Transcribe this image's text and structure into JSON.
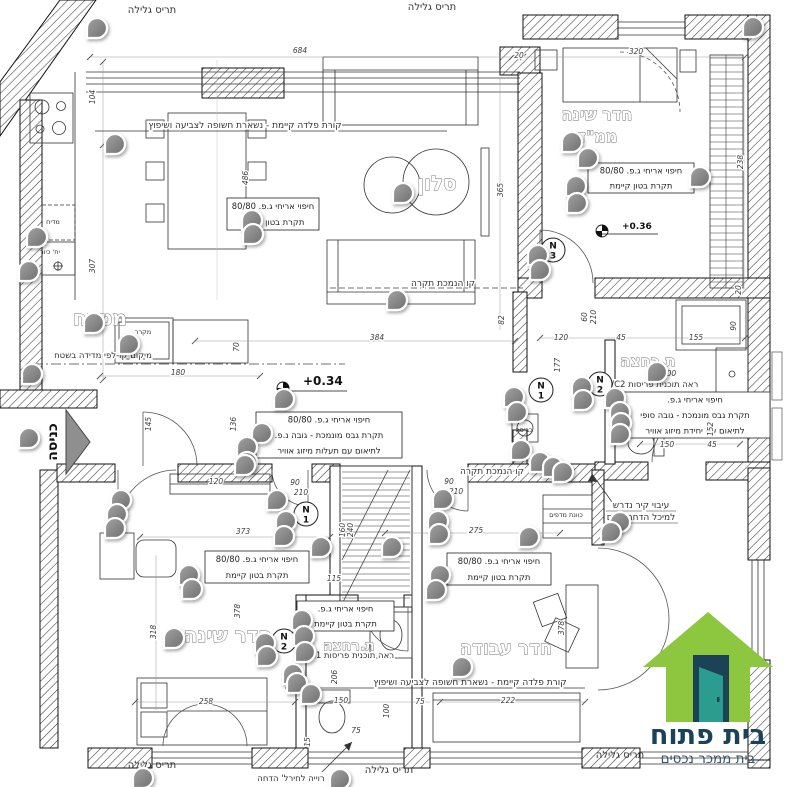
{
  "plan": {
    "entrance_label": "כניסה",
    "rooms": [
      {
        "t": "סלון",
        "x": 437,
        "y": 190,
        "s": 20
      },
      {
        "t": "מטבח",
        "x": 100,
        "y": 325,
        "s": 20
      },
      {
        "t": "חדר שינה",
        "x": 597,
        "y": 120,
        "s": 16
      },
      {
        "t": "ממ\"ד",
        "x": 597,
        "y": 142,
        "s": 16
      },
      {
        "t": "ת.רחצה",
        "x": 648,
        "y": 366,
        "s": 15
      },
      {
        "t": "חדר שינה",
        "x": 228,
        "y": 642,
        "s": 20
      },
      {
        "t": "ת.רחצה",
        "x": 349,
        "y": 650,
        "s": 14
      },
      {
        "t": "חדר עבודה",
        "x": 506,
        "y": 654,
        "s": 18
      }
    ],
    "annotations": [
      {
        "x": 227,
        "y": 198,
        "w": 92,
        "h": 32,
        "lines": [
          "חיפוי אריחי ג.פ. 80/80",
          "תקרת בטון קיימת"
        ]
      },
      {
        "x": 588,
        "y": 163,
        "w": 106,
        "h": 30,
        "lines": [
          "חיפוי אריחי ג.פ. 80/80",
          "תקרת בטון קיימת"
        ]
      },
      {
        "x": 256,
        "y": 412,
        "w": 146,
        "h": 46,
        "lines": [
          "חיפוי אריחי ג.פ. 80/80",
          "תקרת גבס מונמכת - גובה נ.פ.",
          "לתיאום עם תעלות מיזוג אוויר"
        ]
      },
      {
        "x": 620,
        "y": 392,
        "w": 150,
        "h": 46,
        "lines": [
          "חיפוי אריחי ג.פ.",
          "תקרת גבס מונמכת - גובה סופי",
          "לתיאום עם יחידת מיזוג אוויר"
        ]
      },
      {
        "x": 205,
        "y": 551,
        "w": 104,
        "h": 32,
        "lines": [
          "חיפוי אריחי ג.פ. 80/80",
          "תקרת בטון קיימת"
        ]
      },
      {
        "x": 447,
        "y": 553,
        "w": 104,
        "h": 32,
        "lines": [
          "חיפוי אריחי ג.פ. 80/80",
          "תקרת בטון קיימת"
        ]
      },
      {
        "x": 297,
        "y": 601,
        "w": 97,
        "h": 30,
        "lines": [
          "חיפוי אריחי ג.פ.",
          "תקרת בטון קיימת"
        ]
      }
    ],
    "notes": [
      {
        "t": "תריס גלילה",
        "x": 152,
        "y": 13,
        "s": 10
      },
      {
        "t": "תריס גלילה",
        "x": 432,
        "y": 10,
        "s": 10
      },
      {
        "t": "תריס גלילה",
        "x": 152,
        "y": 768,
        "s": 10
      },
      {
        "t": "תריס גלילה",
        "x": 389,
        "y": 773,
        "s": 10
      },
      {
        "t": "תריס גלילה",
        "x": 620,
        "y": 758,
        "s": 10
      },
      {
        "t": "קורת פלדה קיימת - נשארת חשופה לצביעה ושיפוץ",
        "x": 245,
        "y": 128,
        "s": 9,
        "halo": true
      },
      {
        "t": "קורת פלדה קיימת - נשארת חשופה לצביעה ושיפוץ",
        "x": 470,
        "y": 685,
        "s": 9,
        "halo": true
      },
      {
        "t": "קו הנמכת תקרה",
        "x": 443,
        "y": 286,
        "s": 9,
        "halo": true
      },
      {
        "t": "קו הנמכת תקרה",
        "x": 492,
        "y": 474,
        "s": 9,
        "halo": true
      },
      {
        "t": "מיקום קו-לפי מדידה בשטח",
        "x": 103,
        "y": 358,
        "s": 8.5,
        "halo": true
      },
      {
        "t": "ראה תוכנית פריסות WC2",
        "x": 652,
        "y": 387,
        "s": 8.5,
        "halo": true
      },
      {
        "t": "ראה תוכנית פריסות C1",
        "x": 352,
        "y": 658,
        "s": 8.5,
        "halo": true
      },
      {
        "t": "עיבוי קיר נדרש",
        "x": 641,
        "y": 508,
        "s": 9,
        "halo": true
      },
      {
        "t": "למיכל הדחה פנים",
        "x": 641,
        "y": 520,
        "s": 9,
        "halo": true
      },
      {
        "t": "רוייה לחירל' הדחה",
        "x": 291,
        "y": 781,
        "s": 8.5
      },
      {
        "t": "כוונת מדפים",
        "x": 566,
        "y": 517,
        "s": 6.5,
        "halo": true
      },
      {
        "t": "מדיח",
        "x": 53,
        "y": 224,
        "s": 6.5
      },
      {
        "t": "יח' כיור",
        "x": 50,
        "y": 254,
        "s": 6.5
      },
      {
        "t": "מקרר",
        "x": 143,
        "y": 334,
        "s": 6.5
      },
      {
        "t": "כביסה",
        "x": 524,
        "y": 432,
        "s": 6.5
      }
    ],
    "dims": [
      [
        "684",
        300,
        53
      ],
      [
        "320",
        636,
        54
      ],
      [
        "20",
        519,
        58
      ],
      [
        "104",
        95,
        97,
        -90
      ],
      [
        "307",
        95,
        266,
        -90
      ],
      [
        "70",
        239,
        347,
        -90
      ],
      [
        "486",
        248,
        178,
        -90
      ],
      [
        "365",
        503,
        190,
        -90
      ],
      [
        "384",
        377,
        340
      ],
      [
        "82",
        504,
        320,
        -90
      ],
      [
        "180",
        178,
        375
      ],
      [
        "145",
        151,
        424,
        -90
      ],
      [
        "136",
        236,
        424,
        -90
      ],
      [
        "238",
        743,
        162,
        -90
      ],
      [
        "90",
        736,
        326,
        -90
      ],
      [
        "20",
        741,
        290,
        -90
      ],
      [
        "120",
        561,
        340
      ],
      [
        "45",
        621,
        340
      ],
      [
        "155",
        696,
        340
      ],
      [
        "177",
        560,
        365,
        -90
      ],
      [
        "200",
        669,
        376
      ],
      [
        "60",
        587,
        317,
        -90
      ],
      [
        "210",
        596,
        317,
        -90
      ],
      [
        "150",
        667,
        447
      ],
      [
        "45",
        712,
        447
      ],
      [
        "152",
        713,
        429,
        -90
      ],
      [
        "90",
        295,
        485
      ],
      [
        "210",
        301,
        495
      ],
      [
        "90",
        449,
        484
      ],
      [
        "210",
        456,
        494
      ],
      [
        "120",
        216,
        484
      ],
      [
        "373",
        243,
        534
      ],
      [
        "275",
        476,
        533
      ],
      [
        "115",
        334,
        581
      ],
      [
        "318",
        156,
        632,
        -90
      ],
      [
        "378",
        240,
        611,
        -90
      ],
      [
        "378",
        564,
        628,
        -90
      ],
      [
        "160",
        345,
        530,
        -90
      ],
      [
        "240",
        353,
        530,
        -90
      ],
      [
        "258",
        206,
        704
      ],
      [
        "150",
        341,
        703
      ],
      [
        "100",
        389,
        711,
        -90
      ],
      [
        "75",
        420,
        704
      ],
      [
        "222",
        508,
        703
      ],
      [
        "75",
        356,
        733
      ],
      [
        "15",
        310,
        742,
        -90
      ],
      [
        "206",
        337,
        677,
        -90
      ]
    ],
    "levels": [
      {
        "t": "+0.34",
        "sx": 283,
        "sy": 388,
        "tx": 303,
        "ty": 385,
        "s": 12,
        "ux": 347
      },
      {
        "t": "+0.36",
        "sx": 602,
        "sy": 231,
        "tx": 622,
        "ty": 229,
        "s": 9,
        "ux": 658
      }
    ],
    "n_markers": [
      {
        "x": 541,
        "y": 390,
        "n": "1"
      },
      {
        "x": 600,
        "y": 384,
        "n": "2"
      },
      {
        "x": 553,
        "y": 250,
        "n": "3"
      },
      {
        "x": 306,
        "y": 514,
        "n": "1"
      },
      {
        "x": 284,
        "y": 641,
        "n": "2"
      }
    ],
    "pins": [
      [
        97,
        28
      ],
      [
        753,
        27
      ],
      [
        115,
        144
      ],
      [
        37,
        237
      ],
      [
        29,
        271
      ],
      [
        94,
        323
      ],
      [
        129,
        344
      ],
      [
        32,
        374
      ],
      [
        252,
        220
      ],
      [
        253,
        234
      ],
      [
        403,
        193
      ],
      [
        397,
        300
      ],
      [
        572,
        142
      ],
      [
        588,
        158
      ],
      [
        576,
        186
      ],
      [
        577,
        203
      ],
      [
        700,
        177
      ],
      [
        538,
        255
      ],
      [
        540,
        270
      ],
      [
        284,
        399
      ],
      [
        262,
        433
      ],
      [
        247,
        447
      ],
      [
        247,
        462
      ],
      [
        29,
        438
      ],
      [
        514,
        397
      ],
      [
        517,
        412
      ],
      [
        521,
        450
      ],
      [
        540,
        462
      ],
      [
        553,
        467
      ],
      [
        563,
        472
      ],
      [
        582,
        387
      ],
      [
        583,
        400
      ],
      [
        615,
        398
      ],
      [
        620,
        412
      ],
      [
        621,
        423
      ],
      [
        620,
        434
      ],
      [
        657,
        372
      ],
      [
        620,
        522
      ],
      [
        611,
        532
      ],
      [
        245,
        465
      ],
      [
        121,
        500
      ],
      [
        117,
        514
      ],
      [
        115,
        528
      ],
      [
        277,
        500
      ],
      [
        286,
        521
      ],
      [
        284,
        536
      ],
      [
        321,
        547
      ],
      [
        392,
        547
      ],
      [
        189,
        575
      ],
      [
        192,
        589
      ],
      [
        174,
        638
      ],
      [
        443,
        499
      ],
      [
        438,
        521
      ],
      [
        439,
        534
      ],
      [
        440,
        575
      ],
      [
        436,
        590
      ],
      [
        529,
        537
      ],
      [
        462,
        667
      ],
      [
        265,
        643
      ],
      [
        267,
        656
      ],
      [
        302,
        620
      ],
      [
        304,
        636
      ],
      [
        305,
        652
      ],
      [
        293,
        674
      ],
      [
        297,
        683
      ],
      [
        311,
        694
      ],
      [
        143,
        778
      ],
      [
        340,
        779
      ]
    ]
  },
  "logo": {
    "title": "בית פתוח",
    "subtitle": "בית ממכר נכסים",
    "house_color": "#8dc63f",
    "door_color": "#1b4257",
    "leaf_color": "#2a9d8f"
  }
}
